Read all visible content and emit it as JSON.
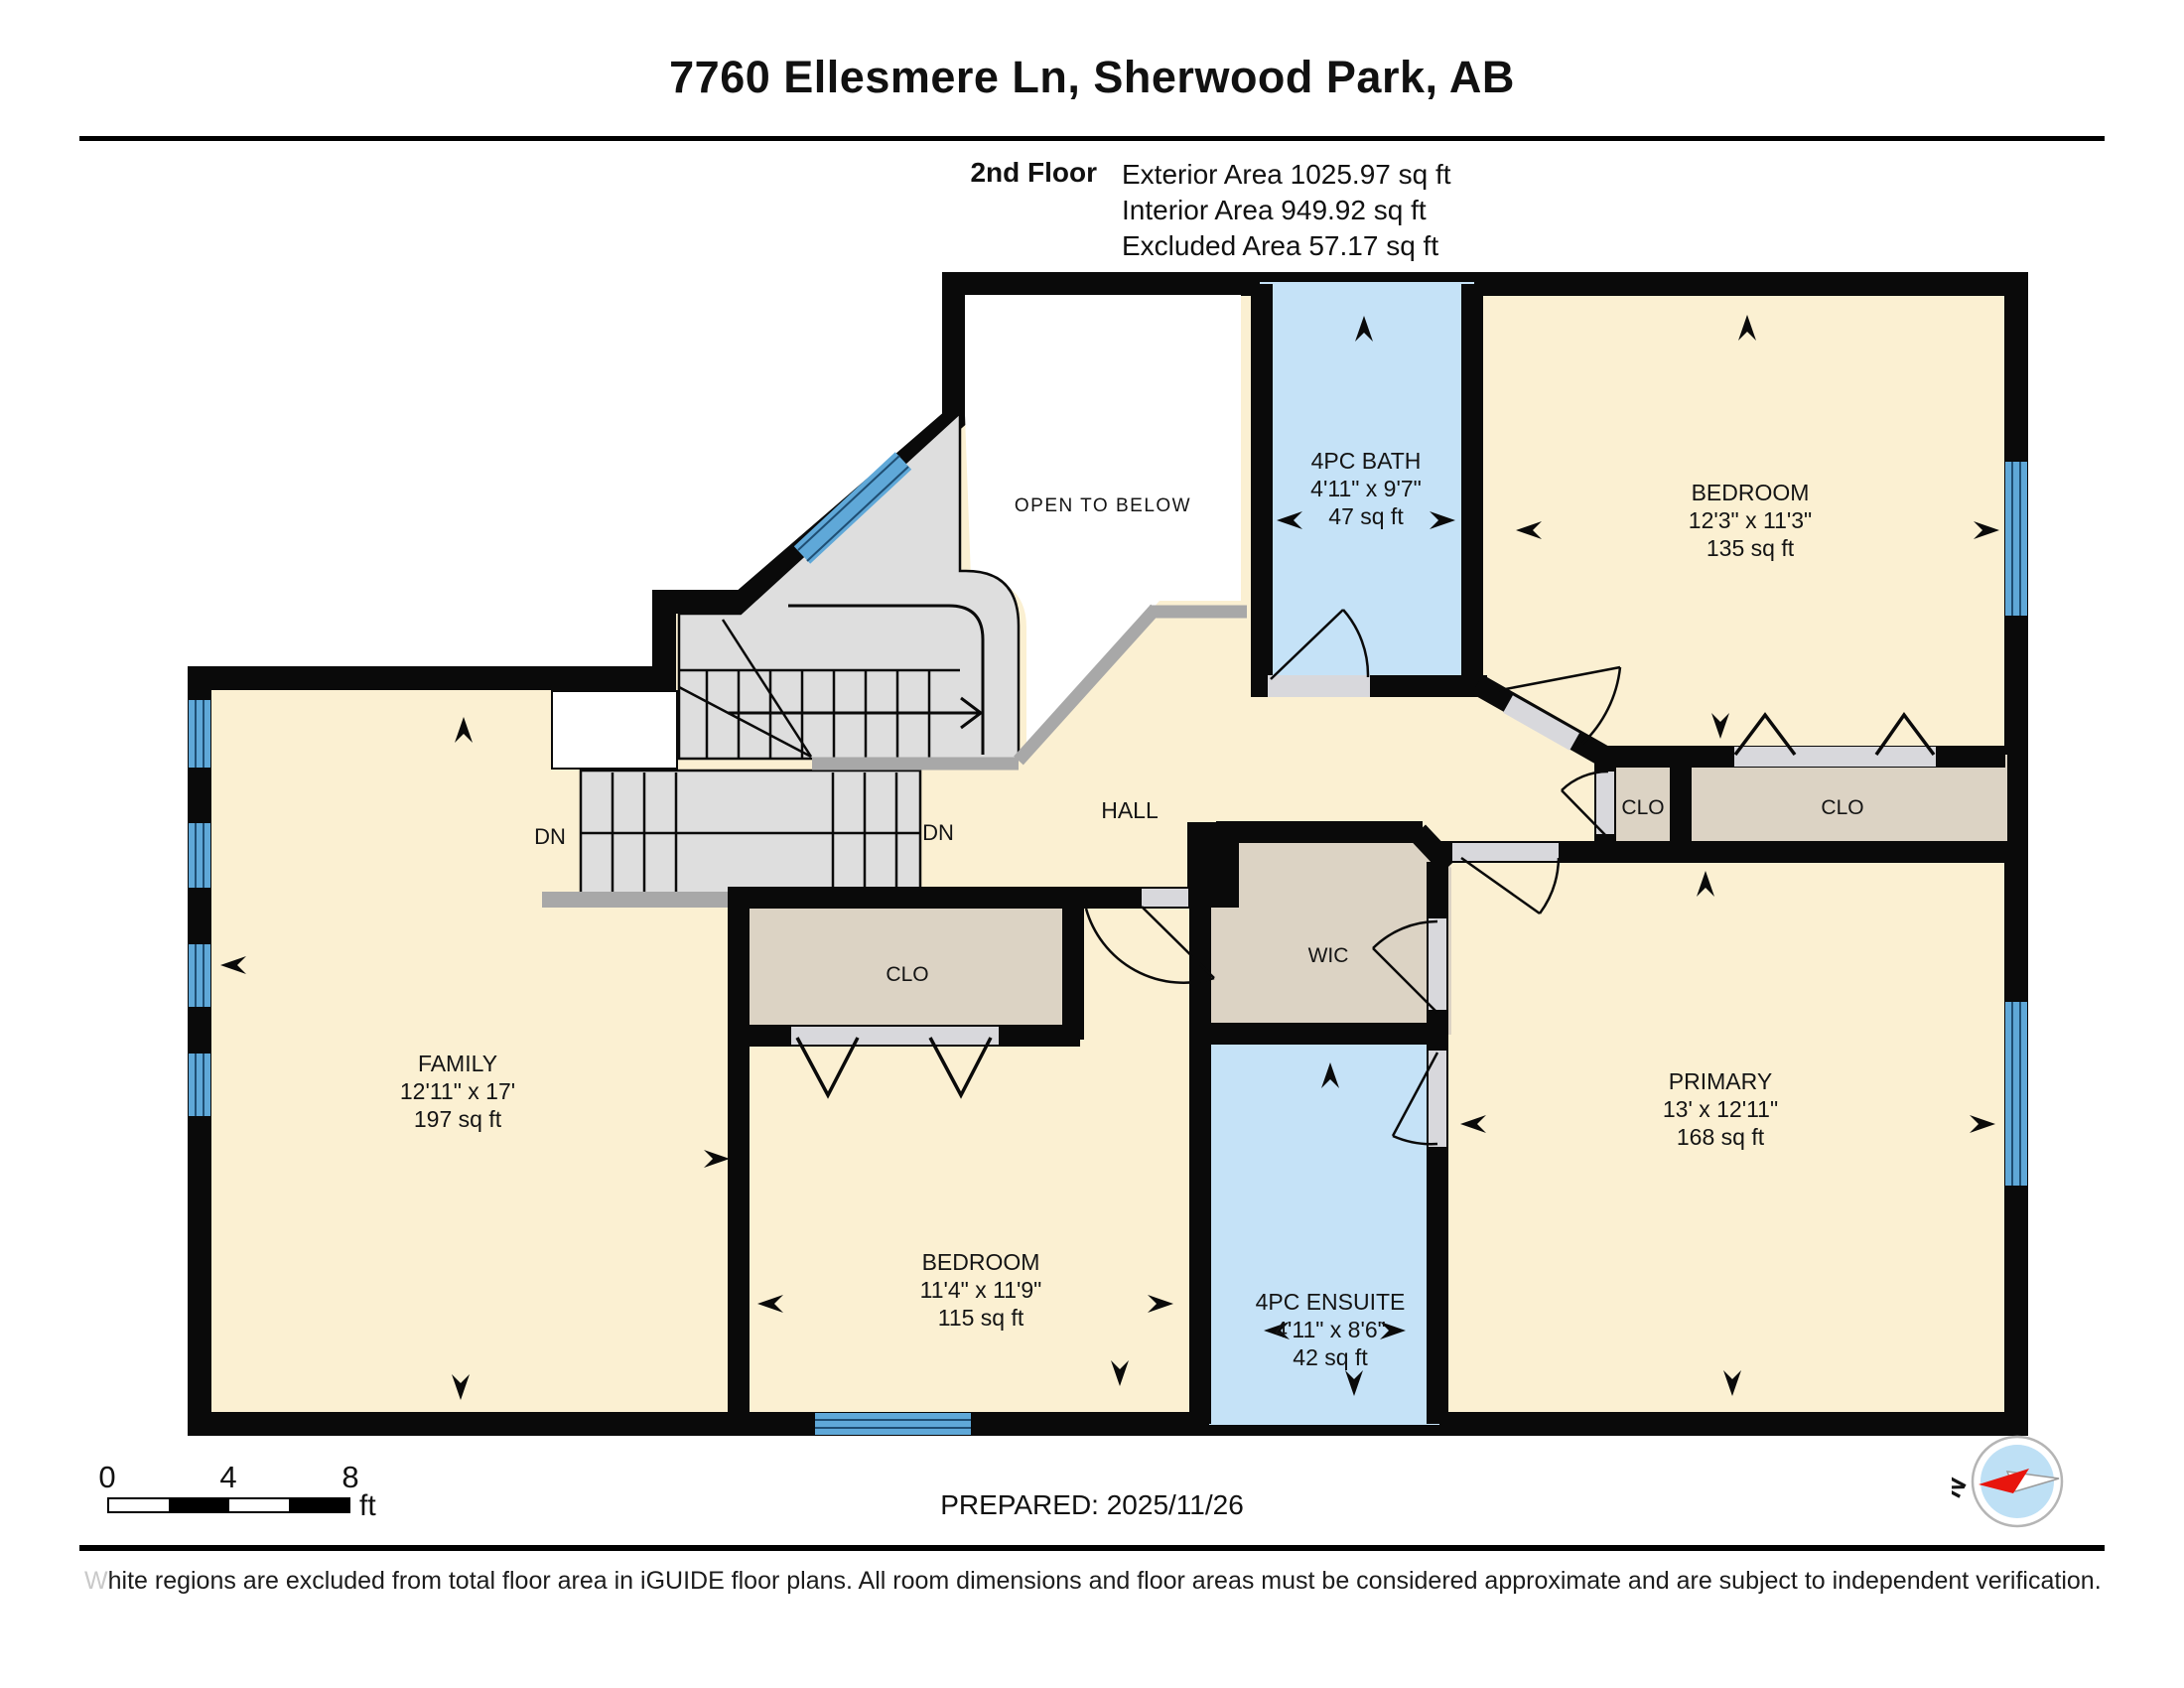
{
  "page": {
    "title": "7760 Ellesmere Ln, Sherwood Park, AB",
    "floor_label": "2nd Floor",
    "areas": {
      "exterior": "Exterior Area 1025.97 sq ft",
      "interior": "Interior Area 949.92 sq ft",
      "excluded": "Excluded Area 57.17 sq ft"
    }
  },
  "rooms": {
    "open_to_below": {
      "name": "OPEN TO BELOW"
    },
    "bath": {
      "name": "4PC BATH",
      "dims": "4'11\" x 9'7\"",
      "area": "47 sq ft"
    },
    "bedroom_right": {
      "name": "BEDROOM",
      "dims": "12'3\" x 11'3\"",
      "area": "135 sq ft"
    },
    "hall": {
      "name": "HALL"
    },
    "family": {
      "name": "FAMILY",
      "dims": "12'11\" x 17'",
      "area": "197 sq ft"
    },
    "bedroom_bottom": {
      "name": "BEDROOM",
      "dims": "11'4\" x 11'9\"",
      "area": "115 sq ft"
    },
    "ensuite": {
      "name": "4PC ENSUITE",
      "dims": "4'11\" x 8'6\"",
      "area": "42 sq ft"
    },
    "primary": {
      "name": "PRIMARY",
      "dims": "13' x 12'11\"",
      "area": "168 sq ft"
    },
    "wic": {
      "name": "WIC"
    },
    "closet_hall": {
      "name": "CLO"
    },
    "closet_primary": {
      "name": "CLO"
    },
    "closet_bedroom": {
      "name": "CLO"
    },
    "stairs": {
      "down_left": "DN",
      "down_right": "DN"
    }
  },
  "footer": {
    "prepared": "PREPARED: 2025/11/26",
    "scale": {
      "zero": "0",
      "four": "4",
      "eight": "8",
      "unit": "ft"
    },
    "compass": {
      "north": "N"
    }
  },
  "disclaimer": {
    "lead": "W",
    "rest": "hite regions are excluded from total floor area in iGUIDE floor plans. All room dimensions and floor areas must be considered approximate and are subject to independent verification."
  },
  "colors": {
    "wall": "#0a0a0a",
    "room_cream": "#FBF0D2",
    "closet_tan": "#DCD3C4",
    "bath_blue": "#C5E2F7",
    "window_blue": "#5FA8D8",
    "stair_grey": "#DEDEDE",
    "railing_grey": "#A8A8A8",
    "door_gap": "#D8D8DC",
    "compass_red": "#E8150D"
  }
}
